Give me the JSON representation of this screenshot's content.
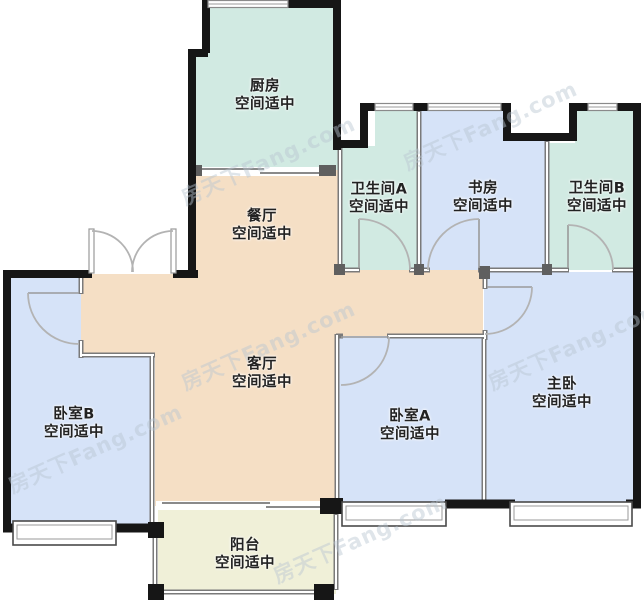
{
  "watermark": "房天下Fang.com",
  "palette": {
    "room_teal": "#d1eae2",
    "room_blue": "#d6e3f8",
    "room_beige": "#f5dfc5",
    "room_cream": "#f0f0d8",
    "wall_dark": "#161616",
    "wall_gray": "#7a7a7a",
    "door_arc": "#b3b3b3",
    "label_text": "#222222",
    "watermark": "#b9c6d2"
  },
  "rooms": [
    {
      "id": "kitchen",
      "name": "厨房",
      "note": "空间适中"
    },
    {
      "id": "dining",
      "name": "餐厅",
      "note": "空间适中"
    },
    {
      "id": "bathroom_a",
      "name": "卫生间A",
      "note": "空间适中"
    },
    {
      "id": "study",
      "name": "书房",
      "note": "空间适中"
    },
    {
      "id": "bathroom_b",
      "name": "卫生间B",
      "note": "空间适中"
    },
    {
      "id": "living",
      "name": "客厅",
      "note": "空间适中"
    },
    {
      "id": "bedroom_b",
      "name": "卧室B",
      "note": "空间适中"
    },
    {
      "id": "bedroom_a",
      "name": "卧室A",
      "note": "空间适中"
    },
    {
      "id": "master",
      "name": "主卧",
      "note": "空间适中"
    },
    {
      "id": "balcony",
      "name": "阳台",
      "note": "空间适中"
    }
  ]
}
